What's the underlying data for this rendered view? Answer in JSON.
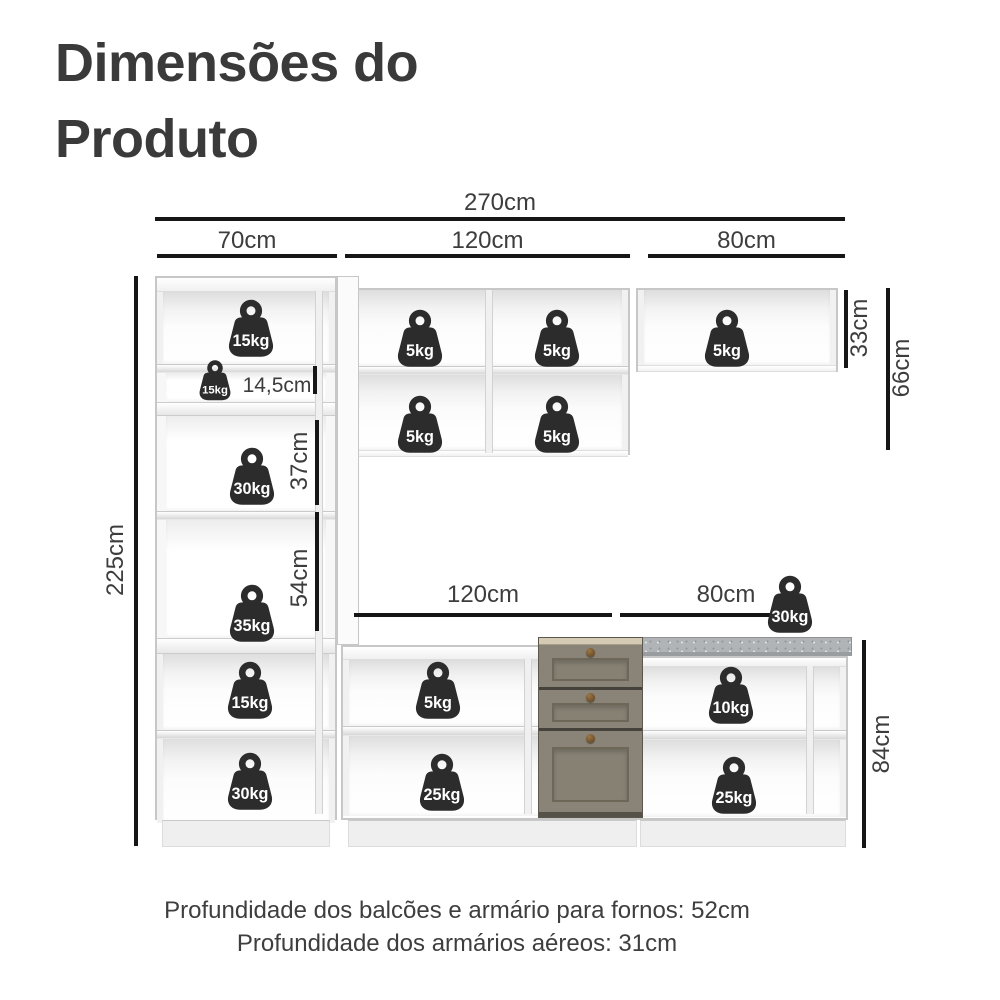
{
  "title": {
    "line1": "Dimensões do",
    "line2": "Produto"
  },
  "dims": {
    "total_width": "270cm",
    "tall_width": "70cm",
    "wall_mid_width": "120cm",
    "wall_right_width": "80cm",
    "height_total": "225cm",
    "shelf_niche_height": "14,5cm",
    "oven_niche_height": "37cm",
    "open_niche_height": "54cm",
    "wall_right_height": "33cm",
    "wall_mid_height": "66cm",
    "base_mid_width": "120cm",
    "base_right_width": "80cm",
    "base_height": "84cm"
  },
  "weights": {
    "tall_top": "15kg",
    "tall_shelf_niche": "15kg",
    "tall_oven_niche": "30kg",
    "tall_open_niche": "35kg",
    "tall_lower": "15kg",
    "tall_bottom": "30kg",
    "wall_mid_top_left": "5kg",
    "wall_mid_top_right": "5kg",
    "wall_mid_bottom_left": "5kg",
    "wall_mid_bottom_right": "5kg",
    "wall_right": "5kg",
    "countertop": "30kg",
    "base_mid_upper": "5kg",
    "base_mid_lower": "25kg",
    "base_right_upper": "10kg",
    "base_right_lower": "25kg"
  },
  "footer": {
    "line1": "Profundidade dos balcões e armário para fornos: 52cm",
    "line2": "Profundidade dos armários aéreos: 31cm"
  },
  "colors": {
    "badge": "#2c2c2c",
    "dimension_line": "#161616",
    "text": "#3d3d3d",
    "drawer_face": "#8a8478",
    "countertop": "#b1b4b7"
  }
}
